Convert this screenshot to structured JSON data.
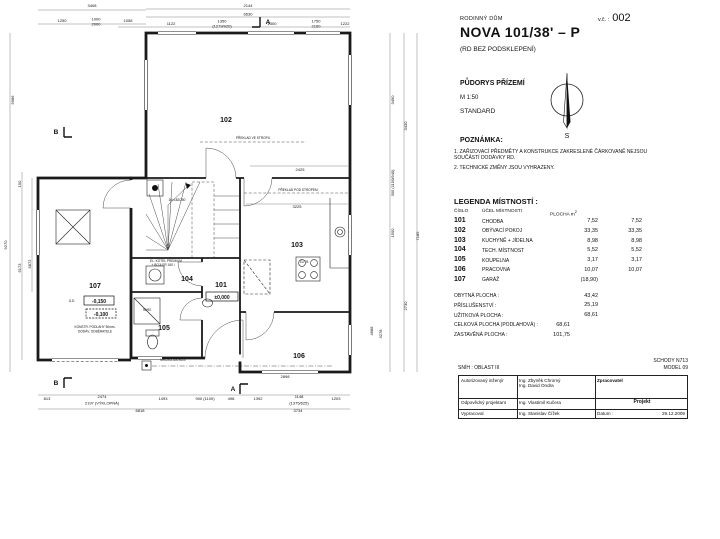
{
  "header": {
    "type_label": "RODINNÝ DŮM",
    "title": "NOVA 101/38' – P",
    "subtitle": "(RD BEZ PODSKLEPENÍ)",
    "sheet_label": "v.č. :",
    "sheet_number": "002",
    "drawing_name": "PŮDORYS PŘÍZEMÍ",
    "scale": "M 1:50",
    "variant": "STANDARD",
    "compass_south": "S"
  },
  "notes": {
    "heading": "POZNÁMKA:",
    "items": [
      "1. ZAŘIZOVACÍ PŘEDMĚTY A KONSTRUKCE ZAKRESLENÉ ČÁRKOVANĚ NEJSOU SOUČÁSTÍ DODÁVKY RD.",
      "2. TECHNICKÉ ZMĚNY JSOU VYHRAZENY."
    ]
  },
  "legend": {
    "heading": "LEGENDA MÍSTNOSTÍ :",
    "col_number": "ČÍSLO",
    "col_purpose": "ÚČEL MÍSTNOSTI",
    "col_area": "PLOCHA m",
    "col_area_sup": "2",
    "rows": [
      {
        "number": "101",
        "purpose": "CHODBA",
        "area1": "7,52",
        "area2": "7,52"
      },
      {
        "number": "102",
        "purpose": "OBÝVACÍ POKOJ",
        "area1": "33,35",
        "area2": "33,35"
      },
      {
        "number": "103",
        "purpose": "KUCHYNĚ + JÍDELNA",
        "area1": "8,98",
        "area2": "8,98"
      },
      {
        "number": "104",
        "purpose": "TECH. MÍSTNOST",
        "area1": "5,52",
        "area2": "5,52"
      },
      {
        "number": "105",
        "purpose": "KOUPELNA",
        "area1": "3,17",
        "area2": "3,17"
      },
      {
        "number": "106",
        "purpose": "PRACOVNA",
        "area1": "10,07",
        "area2": "10,07"
      },
      {
        "number": "107",
        "purpose": "GARÁŽ",
        "area1": "(18,90)",
        "area2": ""
      }
    ]
  },
  "totals": {
    "rows": [
      {
        "label": "OBYTNÁ PLOCHA :",
        "value": "43,42",
        "pos": "far"
      },
      {
        "label": "PŘÍSLUŠENSTVÍ :",
        "value": "25,19",
        "pos": "far"
      },
      {
        "label": "UŽITKOVÁ PLOCHA :",
        "value": "68,61",
        "pos": "far"
      },
      {
        "label": "CELKOVÁ PLOCHA (PODLAHOVÁ) :",
        "value": "68,61",
        "pos": "near"
      },
      {
        "label": "ZASTAVĚNÁ PLOCHA :",
        "value": "101,75",
        "pos": "near"
      }
    ]
  },
  "stamp": {
    "snow": "SNÍH : OBLAST III",
    "stairs": "SCHODY N713",
    "model": "MODEL 09",
    "row1_label": "Autorizovaný inženýr",
    "row1_name1": "Ing. Zbyněk Chromý",
    "row1_name2": "Ing. David Ondra",
    "row2_label": "Odpovědný projektant",
    "row2_name": "Ing. Vlastimil Kučera",
    "row3_label": "Vypracoval",
    "row3_name": "Ing. Stanislav Čížek",
    "processor_label": "Zpracovatel",
    "logo_text": "RD RÝMAŘOV",
    "project_label": "Projekt",
    "date_label": "Datum :",
    "date_value": "29.12.2009"
  },
  "plan": {
    "texts": [
      {
        "c": "room",
        "t": "101",
        "x": 221,
        "y": 287
      },
      {
        "c": "room",
        "t": "102",
        "x": 226,
        "y": 122
      },
      {
        "c": "room",
        "t": "103",
        "x": 297,
        "y": 247
      },
      {
        "c": "room",
        "t": "104",
        "x": 187,
        "y": 281
      },
      {
        "c": "room",
        "t": "105",
        "x": 164,
        "y": 330
      },
      {
        "c": "room",
        "t": "106",
        "x": 299,
        "y": 358
      },
      {
        "c": "room",
        "t": "107",
        "x": 95,
        "y": 288
      },
      {
        "c": "mark",
        "t": "±0,000",
        "x": 222,
        "y": 299
      },
      {
        "c": "mark",
        "t": "-0,150",
        "x": 99,
        "y": 303
      },
      {
        "c": "mark",
        "t": "-0,100",
        "x": 101,
        "y": 316
      },
      {
        "c": "ann",
        "t": "Ú.D.",
        "x": 72,
        "y": 302
      },
      {
        "c": "ann",
        "t": "PŘEKLAD VE STROPU",
        "x": 253,
        "y": 139
      },
      {
        "c": "ann",
        "t": "PŘEKLAD POD STROPEM",
        "x": 298,
        "y": 191
      },
      {
        "c": "ann",
        "t": "16×182/250",
        "x": 177,
        "y": 201
      },
      {
        "c": "ann",
        "t": "ZL/TB",
        "x": 304,
        "y": 263
      },
      {
        "c": "ann",
        "t": "EL. KOTEL PREMIUM",
        "x": 166,
        "y": 262
      },
      {
        "c": "ann",
        "t": "+ BOJLER 160 l",
        "x": 163,
        "y": 266
      },
      {
        "c": "ann",
        "t": "90/90",
        "x": 147,
        "y": 311
      },
      {
        "c": "ann",
        "t": "MŘÍŽKA 600×600",
        "x": 173,
        "y": 361
      },
      {
        "c": "ann",
        "t": "KONSTR. PODLAHY 50mm-",
        "x": 95,
        "y": 328
      },
      {
        "c": "ann",
        "t": "DODÁV. ODBĚRATELE",
        "x": 95,
        "y": 332.5
      },
      {
        "c": "dim",
        "t": "3408",
        "x": 92,
        "y": 7
      },
      {
        "c": "dim",
        "t": "1250",
        "x": 62,
        "y": 22
      },
      {
        "c": "dim",
        "t": "1000",
        "x": 96,
        "y": 20.5
      },
      {
        "c": "dim",
        "t": "2000",
        "x": 96,
        "y": 25.5
      },
      {
        "c": "dim",
        "t": "1058",
        "x": 128,
        "y": 22
      },
      {
        "c": "dim",
        "t": "2144",
        "x": 248,
        "y": 7
      },
      {
        "c": "dim",
        "t": "6630",
        "x": 248,
        "y": 15.5
      },
      {
        "c": "dim",
        "t": "1122",
        "x": 171,
        "y": 25
      },
      {
        "c": "dim",
        "t": "1350",
        "x": 222,
        "y": 22.5
      },
      {
        "c": "dim",
        "t": "(1279/920)",
        "x": 222,
        "y": 27.5
      },
      {
        "c": "dim",
        "t": "1300",
        "x": 272,
        "y": 25
      },
      {
        "c": "dim",
        "t": "1750",
        "x": 316,
        "y": 22.5
      },
      {
        "c": "dim",
        "t": "2160",
        "x": 316,
        "y": 27.5
      },
      {
        "c": "dim",
        "t": "1222",
        "x": 345,
        "y": 25
      },
      {
        "c": "dim",
        "t": "2425",
        "x": 300,
        "y": 171
      },
      {
        "c": "dim",
        "t": "3225",
        "x": 297,
        "y": 208
      },
      {
        "c": "dim",
        "t": "5986",
        "x": 14,
        "y": 100,
        "r": 1
      },
      {
        "c": "dim",
        "t": "9270",
        "x": 7,
        "y": 245,
        "r": 1
      },
      {
        "c": "dim",
        "t": "150",
        "x": 21,
        "y": 184,
        "r": 1
      },
      {
        "c": "dim",
        "t": "6173",
        "x": 21,
        "y": 268,
        "r": 1
      },
      {
        "c": "dim",
        "t": "5872",
        "x": 31,
        "y": 264,
        "r": 1
      },
      {
        "c": "dim",
        "t": "3490",
        "x": 394,
        "y": 100,
        "r": 1
      },
      {
        "c": "dim",
        "t": "3430",
        "x": 407,
        "y": 126,
        "r": 1
      },
      {
        "c": "dim",
        "t": "300 (1150/940)",
        "x": 394,
        "y": 183,
        "r": 1
      },
      {
        "c": "dim",
        "t": "1500",
        "x": 394,
        "y": 233,
        "r": 1
      },
      {
        "c": "dim",
        "t": "2730",
        "x": 407,
        "y": 306,
        "r": 1
      },
      {
        "c": "dim",
        "t": "7185",
        "x": 419,
        "y": 236,
        "r": 1
      },
      {
        "c": "dim",
        "t": "4688",
        "x": 373,
        "y": 331,
        "r": 1
      },
      {
        "c": "dim",
        "t": "3278",
        "x": 382,
        "y": 334,
        "r": 1
      },
      {
        "c": "dim",
        "t": "2898",
        "x": 285,
        "y": 378
      },
      {
        "c": "dim",
        "t": "813",
        "x": 47,
        "y": 400
      },
      {
        "c": "dim",
        "t": "2474",
        "x": 102,
        "y": 398
      },
      {
        "c": "dim",
        "t": "2197 (VÝKLOPNÁ)",
        "x": 102,
        "y": 404.5
      },
      {
        "c": "dim",
        "t": "1493",
        "x": 163,
        "y": 400
      },
      {
        "c": "dim",
        "t": "900 (1100)",
        "x": 205,
        "y": 400
      },
      {
        "c": "dim",
        "t": "498",
        "x": 231,
        "y": 400
      },
      {
        "c": "dim",
        "t": "1392",
        "x": 258,
        "y": 400
      },
      {
        "c": "dim",
        "t": "1148",
        "x": 299,
        "y": 398
      },
      {
        "c": "dim",
        "t": "(1375/625)",
        "x": 299,
        "y": 404.5
      },
      {
        "c": "dim",
        "t": "1203",
        "x": 336,
        "y": 400
      },
      {
        "c": "dim",
        "t": "6818",
        "x": 140,
        "y": 412
      },
      {
        "c": "dim",
        "t": "3734",
        "x": 298,
        "y": 412
      },
      {
        "c": "sec",
        "t": "A",
        "x": 268,
        "y": 24
      },
      {
        "c": "sec",
        "t": "A",
        "x": 233,
        "y": 391
      },
      {
        "c": "sec",
        "t": "B",
        "x": 56,
        "y": 134
      },
      {
        "c": "sec",
        "t": "B",
        "x": 56,
        "y": 385
      }
    ],
    "boxes": [
      {
        "x": 206,
        "y": 292,
        "w": 32,
        "h": 9,
        "dash": false
      },
      {
        "x": 84,
        "y": 296,
        "w": 30,
        "h": 9,
        "dash": false
      },
      {
        "x": 86,
        "y": 309,
        "w": 30,
        "h": 9,
        "dash": true
      }
    ]
  }
}
